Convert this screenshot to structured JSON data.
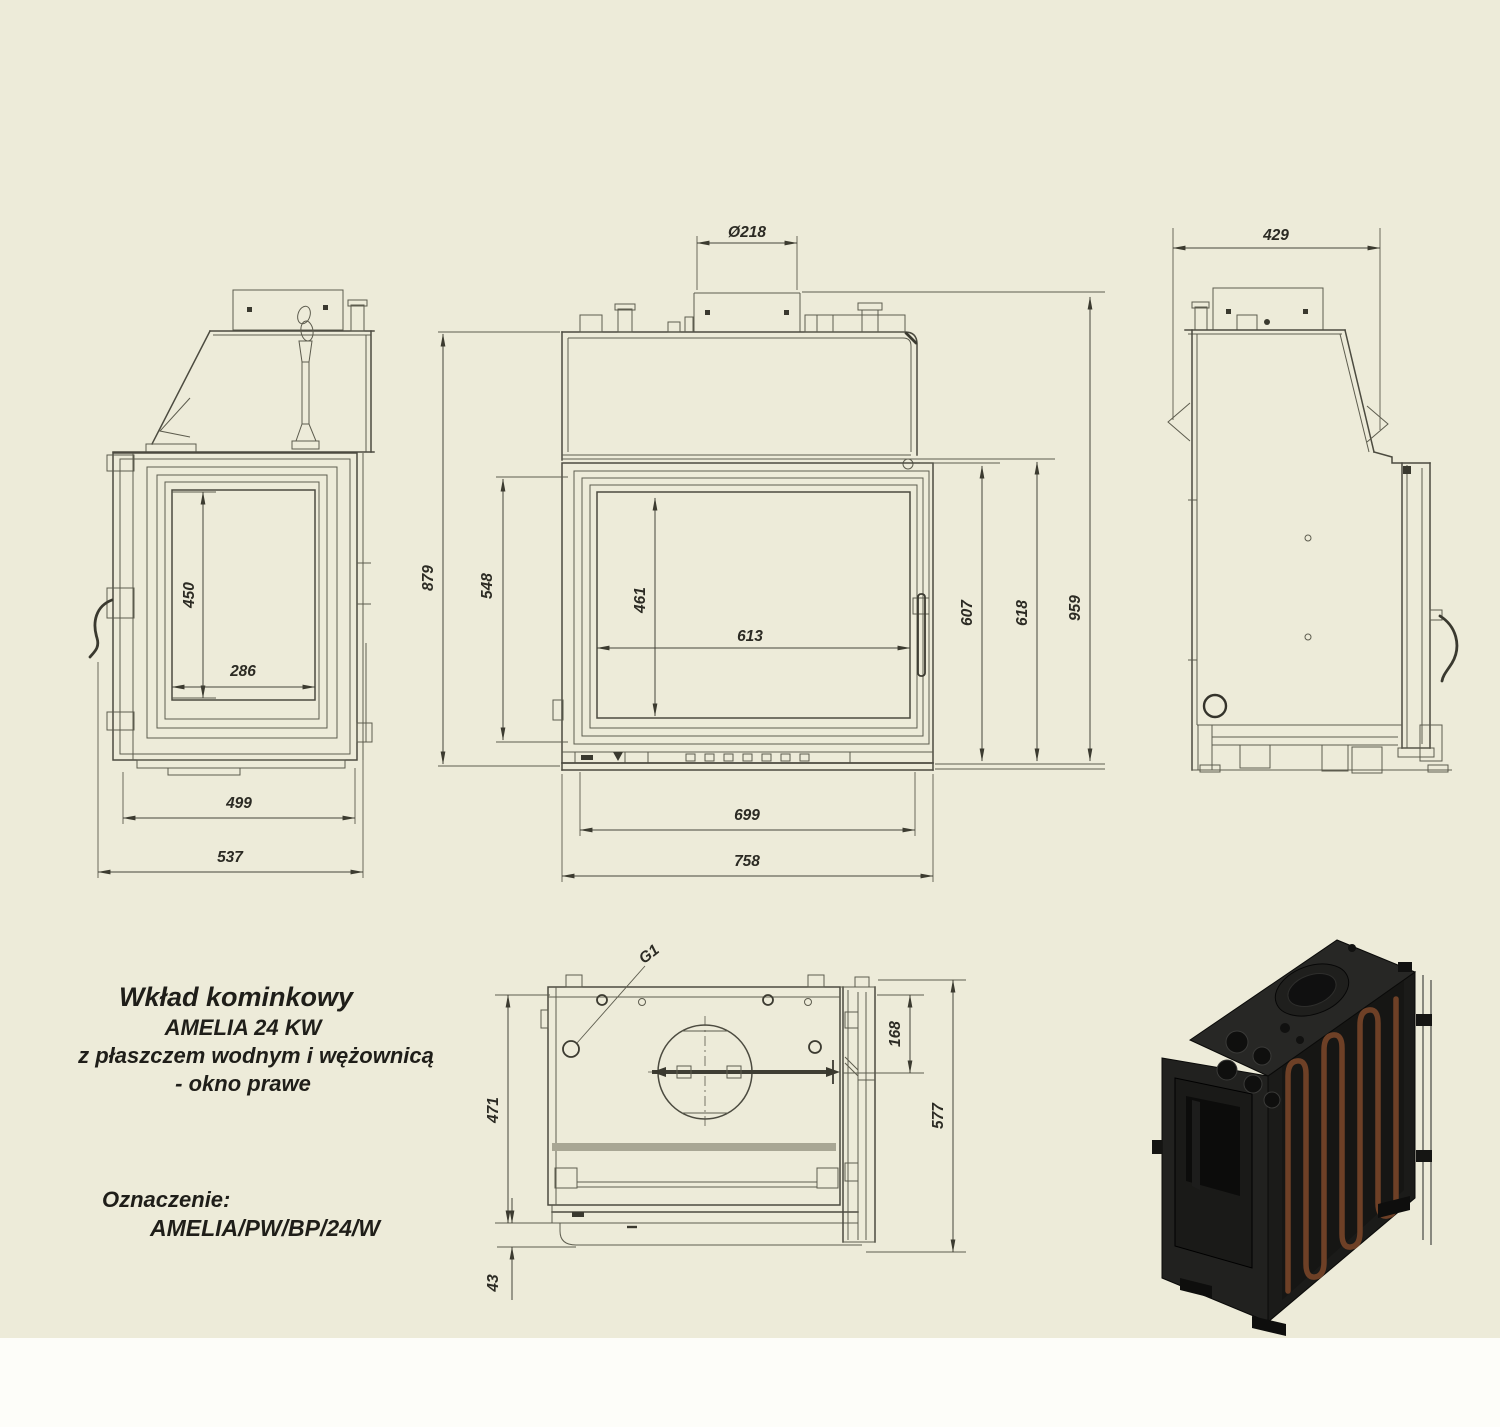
{
  "sheet": {
    "background_color": "#EDEBD9",
    "paper_color": "#FDFDF9",
    "line_color": "#4C4B40"
  },
  "title_block": {
    "line1": "Wkład kominkowy",
    "line2": "AMELIA 24 KW",
    "line3": "z płaszczem wodnym i wężownicą",
    "line4": "- okno prawe",
    "designation_label": "Oznaczenie:",
    "designation_value": "AMELIA/PW/BP/24/W"
  },
  "views": {
    "left_side": {
      "dims": {
        "glass_height": "450",
        "glass_width": "286",
        "body_depth": "499",
        "total_depth": "537"
      }
    },
    "front": {
      "dims": {
        "flue_diameter": "Ø218",
        "total_height_left": "879",
        "door_height_left": "548",
        "glass_height": "461",
        "glass_width": "613",
        "door_height_right": "607",
        "body_height_right": "618",
        "total_height_right": "959",
        "inner_width": "699",
        "total_width": "758"
      }
    },
    "right_side": {
      "dims": {
        "top_depth": "429"
      }
    },
    "bottom": {
      "dims": {
        "coil_connection": "G1",
        "flue_center_offset": "168",
        "body_depth": "471",
        "total_depth": "577",
        "front_step": "43"
      }
    }
  },
  "product_render": {
    "body_color": "#232321",
    "coil_color": "#6E4026",
    "glass_color": "#0C0C0B"
  }
}
